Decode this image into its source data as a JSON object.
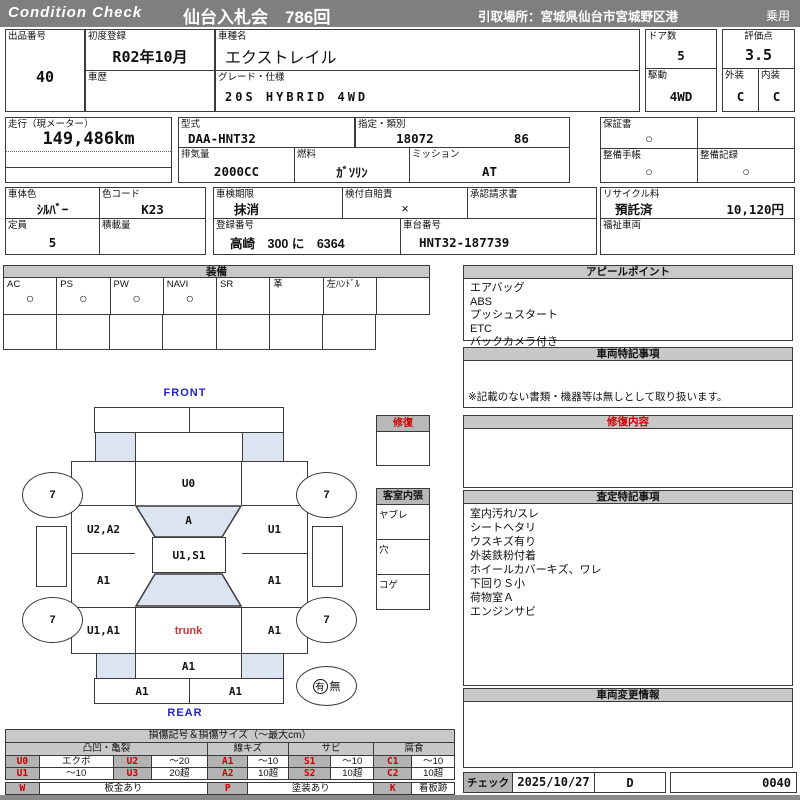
{
  "header": {
    "brand": "Condition  Check",
    "auction": "仙台入札会　786回",
    "pickup": "引取場所：宮城県仙台市宮城野区港",
    "category": "乗用"
  },
  "info": {
    "lot_label": "出品番号",
    "lot": "40",
    "first_reg_label": "初度登録",
    "first_reg": "R02年10月",
    "history_label": "車歴",
    "history": "",
    "name_label": "車種名",
    "name": "エクストレイル",
    "grade_label": "グレード・仕様",
    "grade": "20S HYBRID 4WD",
    "doors_label": "ドア数",
    "doors": "5",
    "score_label": "評価点",
    "score": "3.5",
    "drive_label": "駆動",
    "drive": "4WD",
    "exterior_label": "外装",
    "exterior": "C",
    "interior_label": "内装",
    "interior": "C",
    "mileage_label": "走行（現メーター）",
    "mileage": "149,486km",
    "model_code_label": "型式",
    "model_code": "DAA-HNT32",
    "class_label": "指定・類別",
    "class1": "18072",
    "class2": "86",
    "disp_label": "排気量",
    "disp": "2000CC",
    "fuel_label": "燃料",
    "fuel": "ｶﾞｿﾘﾝ",
    "mission_label": "ミッション",
    "mission": "AT",
    "warranty_label": "保証書",
    "warranty": "○",
    "book_label": "整備手帳",
    "book": "○",
    "record_label": "整備記録",
    "record": "○",
    "color_label": "車体色",
    "color": "ｼﾙﾊﾞｰ",
    "color_code_label": "色コード",
    "color_code": "K23",
    "inspection_label": "車検期限",
    "inspection": "抹消",
    "insurance_label": "検付自賠責",
    "insurance": "×",
    "approval_label": "承認請求書",
    "approval": "",
    "recycle_label": "リサイクル料",
    "recycle_status": "預託済",
    "recycle_fee": "10,120円",
    "capacity_label": "定員",
    "capacity": "5",
    "load_label": "積載量",
    "load": "",
    "reg_label": "登録番号",
    "reg": "高崎　300 に　6364",
    "chassis_label": "車台番号",
    "chassis": "HNT32-187739",
    "welfare_label": "福祉車両",
    "welfare": ""
  },
  "equipment": {
    "title": "装備",
    "items": [
      {
        "label": "AC",
        "value": "○"
      },
      {
        "label": "PS",
        "value": "○"
      },
      {
        "label": "PW",
        "value": "○"
      },
      {
        "label": "NAVI",
        "value": "○"
      },
      {
        "label": "SR",
        "value": ""
      },
      {
        "label": "革",
        "value": ""
      },
      {
        "label": "左ﾊﾝﾄﾞﾙ",
        "value": ""
      },
      {
        "label": "",
        "value": ""
      }
    ],
    "empty_row": [
      "",
      "",
      "",
      "",
      "",
      "",
      ""
    ]
  },
  "appeal": {
    "title": "アピールポイント",
    "items": [
      "エアバッグ",
      "ABS",
      "プッシュスタート",
      "ETC",
      "バックカメラ付き"
    ]
  },
  "vehicle_notes": {
    "title": "車両特記事項",
    "note": "※記載のない書類・機器等は無しとして取り扱います。"
  },
  "repair": {
    "title": "修復内容"
  },
  "assessment": {
    "title": "査定特記事項",
    "items": [
      "室内汚れ/スレ",
      "シートヘタリ",
      "ウスキズ有り",
      "外装鉄粉付着",
      "ホイールカバーキズ、ワレ",
      "下回りＳ小",
      "荷物室Ａ",
      "エンジンサビ"
    ]
  },
  "change_info": {
    "title": "車両変更情報"
  },
  "check": {
    "label": "チェック",
    "date": "2025/10/27",
    "code": "D",
    "number": "0040"
  },
  "diagram": {
    "front": "FRONT",
    "rear": "REAR",
    "panels": {
      "hood": "U0",
      "windshield": "A",
      "roof": "U1,S1",
      "door_fl": "U2,A2",
      "door_fr": "U1",
      "door_rl": "A1",
      "door_rr": "A1",
      "quarter_rl": "U1,A1",
      "quarter_rr": "A1",
      "trunk": "trunk",
      "tailgate": "A1",
      "bumper_rl": "A1",
      "bumper_rr": "A1"
    },
    "wheels": [
      "7",
      "7",
      "7",
      "7"
    ],
    "repair_box": {
      "title": "修復"
    },
    "cabin_box": {
      "title": "客室内張",
      "rows": [
        "ヤブレ",
        "穴",
        "コゲ"
      ]
    },
    "presence": {
      "yes": "有",
      "no": "無"
    }
  },
  "legend": {
    "title": "損傷記号＆損傷サイズ（～最大cm）",
    "groups": [
      "凸凹・亀裂",
      "線キズ",
      "サビ",
      "腐食"
    ],
    "row1": [
      "U0",
      "エクボ",
      "U2",
      "～20",
      "A1",
      "～10",
      "S1",
      "～10",
      "C1",
      "～10"
    ],
    "row2": [
      "U1",
      "～10",
      "U3",
      "20超",
      "A2",
      "10超",
      "S2",
      "10超",
      "C2",
      "10超"
    ],
    "row3": [
      "W",
      "板金あり",
      "P",
      "塗装あり",
      "K",
      "看板跡"
    ],
    "row4": [
      "X",
      "交換跡",
      "G",
      "ガラス交換要す",
      "L",
      "レンズ割れ"
    ]
  }
}
